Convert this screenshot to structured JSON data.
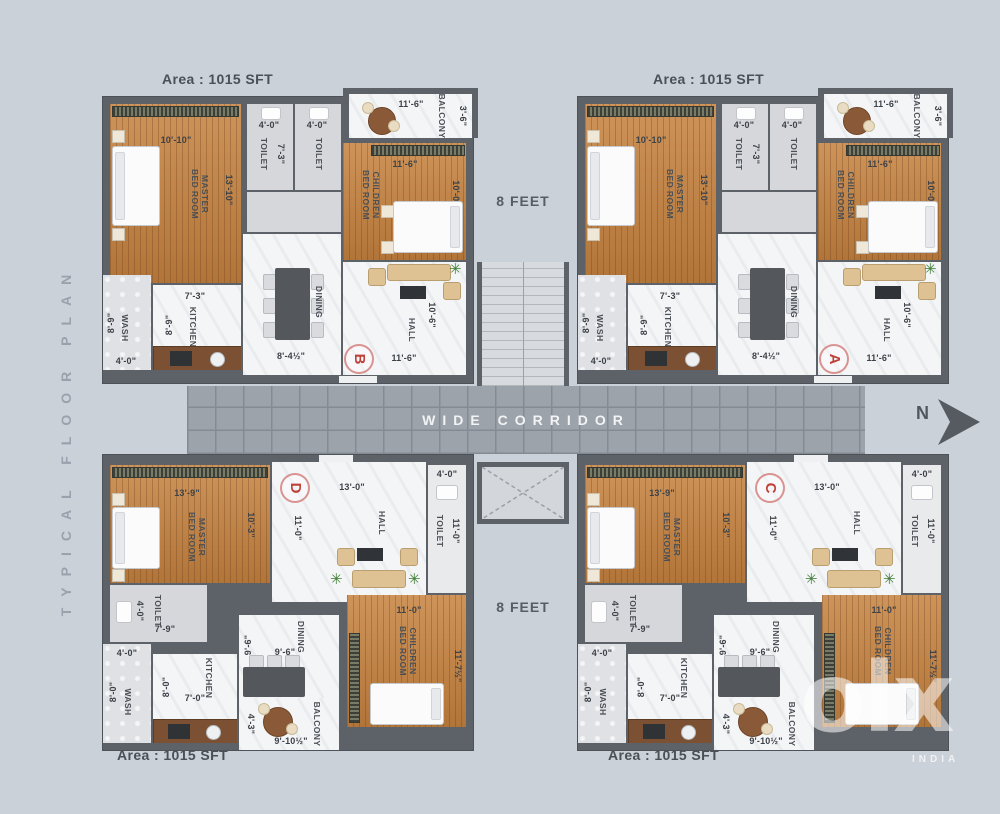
{
  "colors": {
    "background": "#cbd1d9",
    "wall": "#5d6268",
    "wood_floor": "#c6823f",
    "white_floor": "#f4f5f7",
    "corridor": "#9da3aa",
    "unit_letter_red": "#bf4038",
    "watermark": "#ffffff"
  },
  "side_title": "TYPICAL FLOOR PLAN",
  "corridor": {
    "label": "WIDE CORRIDOR"
  },
  "gaps": {
    "top": "8 FEET",
    "bottom": "8 FEET"
  },
  "north": {
    "label": "N"
  },
  "watermark": {
    "logo": "olx",
    "country": "INDIA"
  },
  "area_labels": {
    "top_left": "Area : 1015 SFT",
    "top_right": "Area : 1015 SFT",
    "bottom_left": "Area : 1015 SFT",
    "bottom_right": "Area : 1015 SFT"
  },
  "units": {
    "top_left_letter": "B",
    "top_right_letter": "A",
    "bottom_left_letter": "D",
    "bottom_right_letter": "C"
  },
  "top_plan": {
    "master": {
      "name": "MASTER BED ROOM",
      "w": "10'-10\"",
      "h": "13'-10\""
    },
    "toilet1": {
      "name": "TOILET",
      "w": "4'-0\"",
      "h": "7'-3\""
    },
    "toilet2": {
      "name": "TOILET",
      "w": "4'-0\""
    },
    "balcony": {
      "name": "BALCONY",
      "w": "11'-6\"",
      "h": "3'-6\""
    },
    "children": {
      "name": "CHILDREN BED ROOM",
      "w": "11'-6\"",
      "h": "10'-0\""
    },
    "wash": {
      "name": "WASH",
      "w": "4'-0\"",
      "h": "8'-9\""
    },
    "kitchen": {
      "name": "KITCHEN",
      "w": "7'-3\"",
      "h": "8'-9\""
    },
    "dining": {
      "name": "DINING",
      "w": "8'-4½\""
    },
    "hall": {
      "name": "HALL",
      "w": "11'-6\"",
      "h": "10'-6\""
    }
  },
  "bottom_plan": {
    "master": {
      "name": "MASTER BED ROOM",
      "w": "13'-9\"",
      "h": "10'-3\""
    },
    "hall": {
      "name": "HALL",
      "w": "13'-0\"",
      "h": "11'-0\""
    },
    "toilet_right": {
      "name": "TOILET",
      "w": "4'-0\"",
      "h": "11'-0\""
    },
    "toilet_left": {
      "name": "TOILET",
      "w": "4'-0\"",
      "h": "7'-9\""
    },
    "wash": {
      "name": "WASH",
      "w": "4'-0\"",
      "h": "8'-0\""
    },
    "kitchen": {
      "name": "KITCHEN",
      "w": "7'-0\"",
      "h": "8'-0\""
    },
    "dining": {
      "name": "DINING",
      "w": "9'-6\"",
      "h": "9'-6\""
    },
    "children": {
      "name": "CHILDREN BED ROOM",
      "w": "11'-0\"",
      "h": "11'-7½\""
    },
    "balcony": {
      "name": "BALCONY",
      "w": "9'-10½\"",
      "h": "4'-3\""
    }
  }
}
